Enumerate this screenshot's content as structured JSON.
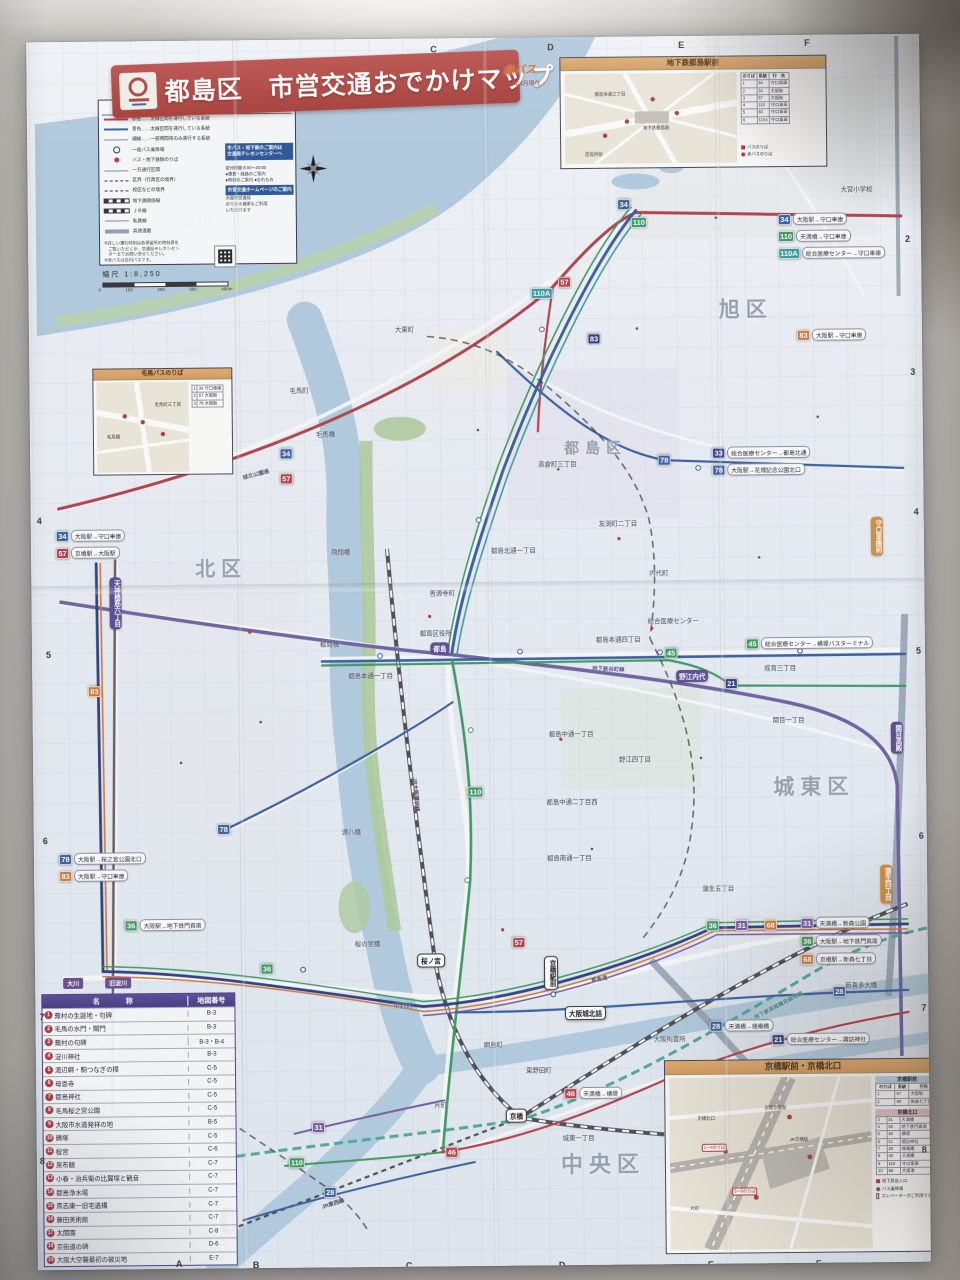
{
  "title": {
    "ward": "都島区",
    "main": "市営交通おでかけマップ",
    "brand": "赤バス",
    "edition": "2002年4月現在"
  },
  "scale": {
    "label": "縮尺 1:8,250",
    "ticks": [
      "0",
      "100",
      "200",
      "300",
      "400m"
    ]
  },
  "legend": {
    "title": "凡　例",
    "rows": [
      {
        "s": "ls-line",
        "c": "#c63a45",
        "t": "赤色……太線区間を運行している系統"
      },
      {
        "s": "ls-line",
        "c": "#2f5fb0",
        "t": "青色……太線区間を運行している系統"
      },
      {
        "s": "ls-thin",
        "c": "",
        "t": "細線……一部時間帯のみ運行する系統"
      },
      {
        "s": "ls-dot",
        "c": "",
        "t": "一般バス乗降場"
      },
      {
        "s": "ls-reddot",
        "c": "",
        "t": "バス・地下鉄駅のりば"
      },
      {
        "s": "ls-thin",
        "c": "",
        "t": "一方通行区間"
      },
      {
        "s": "ls-dash",
        "c": "",
        "t": "区界（行政区の境界）"
      },
      {
        "s": "ls-dash",
        "c": "",
        "t": "校区などの境界"
      },
      {
        "s": "ls-rail",
        "c": "",
        "t": "地下鉄関係線"
      },
      {
        "s": "ls-rail",
        "c": "",
        "t": "ＪＲ線"
      },
      {
        "s": "ls-thin",
        "c": "",
        "t": "私鉄線"
      },
      {
        "s": "ls-hwy",
        "c": "",
        "t": "高速道路"
      }
    ],
    "box1": [
      "市バス・地下鉄のご案内は",
      "交通局テレホンセンターへ"
    ],
    "box1_sub": [
      "受付時間 8:00〜20:00",
      "●運賃・経路のご案内",
      "●時刻のご案内 ●忘れもの"
    ],
    "box2": [
      "市営交通ホームページのご案内"
    ],
    "box2_sub": [
      "大阪市交通局",
      "のりかえ検索もご利用",
      "いただけます"
    ],
    "notes": [
      "※詳しい運行時刻は各停留所の時刻表を",
      "　ご覧いただくか、交通局テレホンセン",
      "　ターまでお問い合せください。",
      "※赤バスは百円バスです。"
    ]
  },
  "grid": {
    "top": [
      {
        "t": "C",
        "x": 436,
        "y": 44
      },
      {
        "t": "D",
        "x": 553,
        "y": 43
      },
      {
        "t": "E",
        "x": 684,
        "y": 42
      },
      {
        "t": "F",
        "x": 810,
        "y": 41
      }
    ],
    "bottom": [
      {
        "t": "A",
        "x": 170,
        "y": 1256
      },
      {
        "t": "B",
        "x": 247,
        "y": 1258
      },
      {
        "t": "C",
        "x": 400,
        "y": 1260
      },
      {
        "t": "D",
        "x": 553,
        "y": 1261
      },
      {
        "t": "E",
        "x": 702,
        "y": 1262
      },
      {
        "t": "F",
        "x": 810,
        "y": 1262
      }
    ],
    "left": [
      {
        "t": "4",
        "x": 38,
        "y": 512
      },
      {
        "t": "5",
        "x": 46,
        "y": 646
      },
      {
        "t": "6",
        "x": 41,
        "y": 832
      },
      {
        "t": "7",
        "x": 36,
        "y": 1008
      },
      {
        "t": "8",
        "x": 35,
        "y": 1152
      }
    ],
    "right": [
      {
        "t": "2",
        "x": 909,
        "y": 238
      },
      {
        "t": "3",
        "x": 913,
        "y": 371
      },
      {
        "t": "4",
        "x": 915,
        "y": 511
      },
      {
        "t": "5",
        "x": 916,
        "y": 650
      },
      {
        "t": "6",
        "x": 917,
        "y": 835
      },
      {
        "t": "7",
        "x": 918,
        "y": 1007
      },
      {
        "t": "8",
        "x": 917,
        "y": 1149
      }
    ]
  },
  "wards": [
    {
      "t": "北区",
      "x": 196,
      "y": 550,
      "fs": 20
    },
    {
      "t": "旭区",
      "x": 722,
      "y": 296,
      "fs": 21
    },
    {
      "t": "都島区",
      "x": 566,
      "y": 438,
      "fs": 15
    },
    {
      "t": "城東区",
      "x": 772,
      "y": 774,
      "fs": 21
    },
    {
      "t": "中央区",
      "x": 556,
      "y": 1148,
      "fs": 22
    }
  ],
  "water_labels": [
    {
      "t": "淀川",
      "x": 186,
      "y": 206,
      "fs": 13,
      "rot": -12
    }
  ],
  "route_names": [
    {
      "t": "地下鉄谷町線",
      "x": 592,
      "y": 666,
      "c": "#5c4a9e",
      "rot": 3
    },
    {
      "t": "JR大阪環状線",
      "x": 398,
      "y": 790,
      "c": "#3f3f49",
      "rot": 86
    },
    {
      "t": "地下鉄長堀鶴見緑地線",
      "x": 748,
      "y": 1004,
      "c": "#2c8f80",
      "rot": -27
    },
    {
      "t": "JR東西線",
      "x": 316,
      "y": 1198,
      "c": "#3f3f49",
      "rot": -17
    },
    {
      "t": "城北公園通",
      "x": 244,
      "y": 468,
      "c": "#556",
      "rot": -14
    },
    {
      "t": "都島通",
      "x": 588,
      "y": 976,
      "c": "#556",
      "rot": -10
    }
  ],
  "places": [
    {
      "t": "毛馬町",
      "x": 292,
      "y": 384
    },
    {
      "t": "大東町",
      "x": 398,
      "y": 324
    },
    {
      "t": "友渕町二丁目",
      "x": 600,
      "y": 520
    },
    {
      "t": "高倉町三丁目",
      "x": 540,
      "y": 460
    },
    {
      "t": "都島北通一丁目",
      "x": 492,
      "y": 546
    },
    {
      "t": "善源寺町",
      "x": 430,
      "y": 588
    },
    {
      "t": "内代町",
      "x": 650,
      "y": 570
    },
    {
      "t": "都島本通四丁目",
      "x": 596,
      "y": 636
    },
    {
      "t": "都島本通一丁目",
      "x": 348,
      "y": 670
    },
    {
      "t": "都島中通一丁目",
      "x": 548,
      "y": 730
    },
    {
      "t": "都島中通二丁目西",
      "x": 545,
      "y": 798
    },
    {
      "t": "都島南通一丁目",
      "x": 545,
      "y": 854
    },
    {
      "t": "野江四丁目",
      "x": 618,
      "y": 756
    },
    {
      "t": "成育三丁目",
      "x": 764,
      "y": 666
    },
    {
      "t": "関目一丁目",
      "x": 772,
      "y": 718
    },
    {
      "t": "蒲生五丁目",
      "x": 700,
      "y": 886
    },
    {
      "t": "東野田町",
      "x": 522,
      "y": 1066
    },
    {
      "t": "網島町",
      "x": 480,
      "y": 1040
    },
    {
      "t": "片町",
      "x": 430,
      "y": 1100
    },
    {
      "t": "大阪拘置所",
      "x": 650,
      "y": 1036
    },
    {
      "t": "新喜多大橋",
      "x": 842,
      "y": 984
    },
    {
      "t": "城東一丁目",
      "x": 558,
      "y": 1134
    },
    {
      "t": "中野町",
      "x": 390,
      "y": 1000
    },
    {
      "t": "大宮小学校",
      "x": 845,
      "y": 188
    },
    {
      "t": "総合医療センター",
      "x": 648,
      "y": 618
    },
    {
      "t": "都島区役所",
      "x": 420,
      "y": 628
    },
    {
      "t": "毛馬橋",
      "x": 318,
      "y": 428
    },
    {
      "t": "都島橋",
      "x": 320,
      "y": 638
    },
    {
      "t": "源八橋",
      "x": 340,
      "y": 826
    },
    {
      "t": "桜の宮橋",
      "x": 352,
      "y": 938
    },
    {
      "t": "飛翔橋",
      "x": 332,
      "y": 546
    }
  ],
  "stations": [
    {
      "t": "天神橋筋六丁目",
      "x": 116,
      "y": 600,
      "style": "subway",
      "v": true
    },
    {
      "t": "都島",
      "x": 440,
      "y": 648,
      "style": "subway",
      "v": false
    },
    {
      "t": "野江内代",
      "x": 692,
      "y": 678,
      "style": "subway",
      "v": false
    },
    {
      "t": "関目高殿",
      "x": 896,
      "y": 742,
      "style": "subway",
      "v": true
    },
    {
      "t": "桜ノ宮",
      "x": 428,
      "y": 960,
      "style": "jr",
      "v": false
    },
    {
      "t": "京橋",
      "x": 512,
      "y": 1116,
      "style": "jr",
      "v": false
    },
    {
      "t": "大阪城北詰",
      "x": 582,
      "y": 1014,
      "style": "jr",
      "v": false
    },
    {
      "t": "天満橋",
      "x": 222,
      "y": 1218,
      "style": "subway",
      "v": true
    },
    {
      "t": "守口車庫前",
      "x": 878,
      "y": 540,
      "style": "terminal",
      "v": true
    },
    {
      "t": "蒲生四丁目",
      "x": 884,
      "y": 888,
      "style": "terminal",
      "v": true
    },
    {
      "t": "京橋駅前",
      "x": 548,
      "y": 974,
      "style": "jr",
      "v": true
    }
  ],
  "ribbons": [
    {
      "t": "大川",
      "x": 60,
      "y": 974
    },
    {
      "t": "旧淀川",
      "x": 102,
      "y": 974
    }
  ],
  "routes": {
    "colors": {
      "blue": "#2f5fb0",
      "red": "#c63a45",
      "green": "#2e9e5b",
      "navy": "#2b3f8e",
      "teal": "#2aa0a8",
      "orange": "#e0762a",
      "purple": "#7a57b0"
    },
    "inline": [
      {
        "n": "34",
        "c": "blue",
        "x": 628,
        "y": 206
      },
      {
        "n": "110",
        "c": "green",
        "x": 643,
        "y": 224
      },
      {
        "n": "57",
        "c": "red",
        "x": 568,
        "y": 283
      },
      {
        "n": "110A",
        "c": "teal",
        "x": 545,
        "y": 294
      },
      {
        "n": "83",
        "c": "navy",
        "x": 597,
        "y": 340
      },
      {
        "n": "34",
        "c": "blue",
        "x": 288,
        "y": 452
      },
      {
        "n": "57",
        "c": "red",
        "x": 288,
        "y": 477
      },
      {
        "n": "78",
        "c": "blue",
        "x": 666,
        "y": 462
      },
      {
        "n": "45",
        "c": "green",
        "x": 671,
        "y": 655
      },
      {
        "n": "21",
        "c": "navy",
        "x": 731,
        "y": 686
      },
      {
        "n": "83",
        "c": "orange",
        "x": 94,
        "y": 688
      },
      {
        "n": "78",
        "c": "blue",
        "x": 222,
        "y": 827
      },
      {
        "n": "110",
        "c": "green",
        "x": 474,
        "y": 792
      },
      {
        "n": "36",
        "c": "green",
        "x": 264,
        "y": 967
      },
      {
        "n": "57",
        "c": "red",
        "x": 516,
        "y": 943
      },
      {
        "n": "36",
        "c": "green",
        "x": 710,
        "y": 928
      },
      {
        "n": "31",
        "c": "purple",
        "x": 739,
        "y": 928
      },
      {
        "n": "68",
        "c": "orange",
        "x": 768,
        "y": 928
      },
      {
        "n": "28",
        "c": "blue",
        "x": 836,
        "y": 995
      },
      {
        "n": "31",
        "c": "purple",
        "x": 314,
        "y": 1126
      },
      {
        "n": "110",
        "c": "green",
        "x": 292,
        "y": 1161
      },
      {
        "n": "46",
        "c": "red",
        "x": 447,
        "y": 1152
      },
      {
        "n": "28",
        "c": "blue",
        "x": 325,
        "y": 1191
      }
    ],
    "labeled": [
      {
        "n": "34",
        "c": "blue",
        "x": 782,
        "y": 222,
        "t": "大阪駅→守口車庫"
      },
      {
        "n": "110",
        "c": "green",
        "x": 782,
        "y": 239,
        "t": "天満橋→守口車庫"
      },
      {
        "n": "110A",
        "c": "teal",
        "x": 782,
        "y": 256,
        "t": "総合医療センター→守口車庫"
      },
      {
        "n": "83",
        "c": "orange",
        "x": 800,
        "y": 338,
        "t": "大阪駅→守口車庫"
      },
      {
        "n": "34",
        "c": "blue",
        "x": 57,
        "y": 532,
        "t": "大阪駅→守口車庫"
      },
      {
        "n": "57",
        "c": "red",
        "x": 57,
        "y": 549,
        "t": "京橋駅→大阪駅"
      },
      {
        "n": "33",
        "c": "navy",
        "x": 714,
        "y": 455,
        "t": "総合医療センター→都島北通"
      },
      {
        "n": "78",
        "c": "blue",
        "x": 714,
        "y": 472,
        "t": "大阪駅→花博記念公園北口"
      },
      {
        "n": "45",
        "c": "green",
        "x": 746,
        "y": 646,
        "t": "総合医療センター→横堤バスターミナル"
      },
      {
        "n": "78",
        "c": "blue",
        "x": 57,
        "y": 855,
        "t": "大阪駅→桜之宮公園北口"
      },
      {
        "n": "83",
        "c": "orange",
        "x": 57,
        "y": 872,
        "t": "大阪駅→守口車庫"
      },
      {
        "n": "36",
        "c": "green",
        "x": 122,
        "y": 922,
        "t": "大阪駅→地下鉄門真南"
      },
      {
        "n": "31",
        "c": "purple",
        "x": 798,
        "y": 926,
        "t": "天満橋→新森公園"
      },
      {
        "n": "36",
        "c": "green",
        "x": 798,
        "y": 944,
        "t": "大阪駅→地下鉄門真南"
      },
      {
        "n": "68",
        "c": "orange",
        "x": 798,
        "y": 962,
        "t": "京橋駅→新森七丁目"
      },
      {
        "n": "28",
        "c": "blue",
        "x": 706,
        "y": 1028,
        "t": "天満橋→徳庵橋"
      },
      {
        "n": "21",
        "c": "navy",
        "x": 768,
        "y": 1042,
        "t": "総合医療センター→諏訪神社"
      },
      {
        "n": "46",
        "c": "red",
        "x": 560,
        "y": 1094,
        "t": "天満橋→横堤"
      }
    ]
  },
  "insets": {
    "subway": {
      "header": "地下鉄都島駅前",
      "labels": [
        {
          "t": "地下鉄都島駅",
          "x": 78,
          "y": 52
        },
        {
          "t": "都島本通三丁目",
          "x": 30,
          "y": 18
        },
        {
          "t": "区役所前",
          "x": 20,
          "y": 78
        }
      ],
      "cols": [
        "のりば",
        "系統",
        "行　先"
      ],
      "rows": [
        [
          "1",
          "34",
          "守口車庫"
        ],
        [
          "2",
          "34",
          "大阪駅"
        ],
        [
          "3",
          "57",
          "大阪駅"
        ],
        [
          "4",
          "110",
          "守口車庫"
        ],
        [
          "5",
          "83",
          "守口車庫"
        ],
        [
          "6",
          "110A",
          "守口車庫"
        ]
      ],
      "legend": [
        {
          "ic": "ic-sq",
          "t": "バスのりば"
        },
        {
          "ic": "ic-ci",
          "t": "赤バスのりば"
        }
      ]
    },
    "kema": {
      "header": "毛馬バスのりば",
      "labels": [
        {
          "t": "毛馬橋",
          "x": 10,
          "y": 52
        },
        {
          "t": "毛馬町三丁目",
          "x": 58,
          "y": 20
        }
      ],
      "rows": [
        [
          "1",
          "34 守口車庫"
        ],
        [
          "2",
          "57 大阪駅"
        ],
        [
          "3",
          "78 大阪駅"
        ]
      ]
    },
    "kyobashi": {
      "header": "京橋駅前・京橋北口",
      "labels": [
        {
          "t": "JR京橋駅",
          "x": 120,
          "y": 60
        },
        {
          "t": "京阪京橋駅",
          "x": 95,
          "y": 28
        },
        {
          "t": "京橋北口",
          "x": 28,
          "y": 38
        },
        {
          "t": "片町",
          "x": 20,
          "y": 128
        }
      ],
      "tags": [
        {
          "t": "1〜4のりば",
          "x": 32,
          "y": 66
        },
        {
          "t": "5〜8のりば",
          "x": 62,
          "y": 110
        }
      ],
      "t1_title": "京橋駅前",
      "t1_cols": [
        "のりば",
        "系統",
        "行先"
      ],
      "t1_rows": [
        [
          "1",
          "57",
          "大阪駅"
        ],
        [
          "2",
          "68",
          "新森七丁目"
        ]
      ],
      "t2_title": "京橋北口",
      "t2_rows": [
        [
          "3",
          "31",
          "天満橋"
        ],
        [
          "4",
          "36",
          "地下鉄門真南"
        ],
        [
          "5",
          "46",
          "横堤"
        ],
        [
          "6",
          "21",
          "諏訪神社"
        ],
        [
          "7",
          "28",
          "徳庵橋"
        ],
        [
          "8",
          "46",
          "天満橋"
        ],
        [
          "9",
          "110",
          "守口車庫"
        ],
        [
          "10",
          "68",
          "大阪港"
        ]
      ],
      "legend": [
        {
          "ic": "ic-sq",
          "t": "地下鉄出入口"
        },
        {
          "ic": "ic-ci",
          "t": "バス乗降場"
        },
        {
          "ic": "ic-el",
          "t": "エレベーターがご利用できます"
        }
      ]
    }
  },
  "landmarks": {
    "name_col": "名　　称",
    "ref_col": "地図番号",
    "rows": [
      {
        "n": "1",
        "name": "蕪村の生誕地・句碑",
        "ref": "B-3"
      },
      {
        "n": "2",
        "name": "毛馬の水門・閘門",
        "ref": "B-3"
      },
      {
        "n": "3",
        "name": "蕪村の句碑",
        "ref": "B-3・B-4"
      },
      {
        "n": "4",
        "name": "淀川神社",
        "ref": "B-3"
      },
      {
        "n": "5",
        "name": "渡辺綱・駒つなぎの樟",
        "ref": "C-5"
      },
      {
        "n": "6",
        "name": "母恩寺",
        "ref": "C-5"
      },
      {
        "n": "7",
        "name": "都島神社",
        "ref": "C-5"
      },
      {
        "n": "8",
        "name": "毛馬桜之宮公園",
        "ref": "C-5"
      },
      {
        "n": "9",
        "name": "大阪市水道発祥の地",
        "ref": "B-5"
      },
      {
        "n": "10",
        "name": "鵺塚",
        "ref": "C-5"
      },
      {
        "n": "11",
        "name": "桜宮",
        "ref": "C-6"
      },
      {
        "n": "12",
        "name": "泉布観",
        "ref": "C-7"
      },
      {
        "n": "13",
        "name": "小春・治兵衛の比翼塚と観音",
        "ref": "C-7"
      },
      {
        "n": "14",
        "name": "都島浄水場",
        "ref": "C-7"
      },
      {
        "n": "15",
        "name": "貴志康一旧宅遺構",
        "ref": "C-7"
      },
      {
        "n": "16",
        "name": "藤田美術館",
        "ref": "C-7"
      },
      {
        "n": "17",
        "name": "太閤園",
        "ref": "C-8"
      },
      {
        "n": "18",
        "name": "京街道の碑",
        "ref": "D-6"
      },
      {
        "n": "19",
        "name": "大阪大空襲最初の被災地",
        "ref": "E-7"
      }
    ]
  }
}
